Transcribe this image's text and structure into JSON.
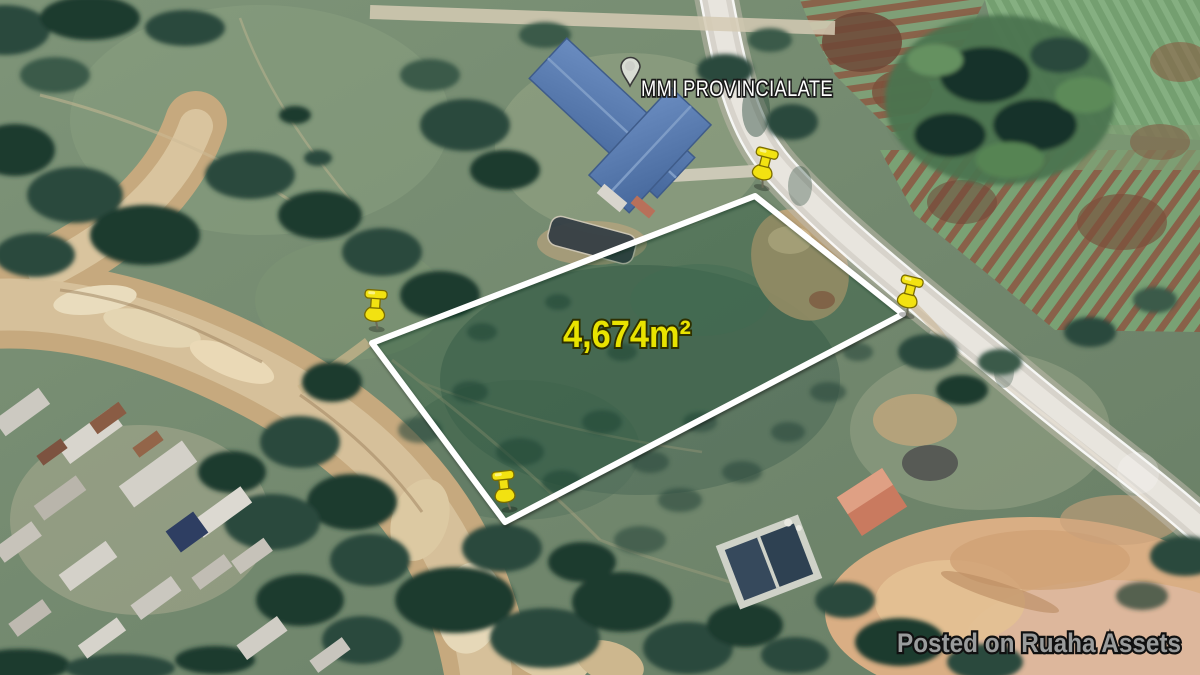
{
  "map": {
    "place_label": "MMI PROVINCIALATE",
    "area_label": "4,674m²",
    "watermark": "Posted on Ruaha Assets",
    "pushpin_count": 4
  },
  "colors": {
    "boundary": "#ffffff",
    "pushpin": "#f2e211",
    "area_label": "#e9e300",
    "place_label": "#ffffff",
    "watermark": "#9a9c9c"
  },
  "icons": {
    "corner_marker": "pushpin-icon",
    "place_marker": "placemark-icon"
  }
}
